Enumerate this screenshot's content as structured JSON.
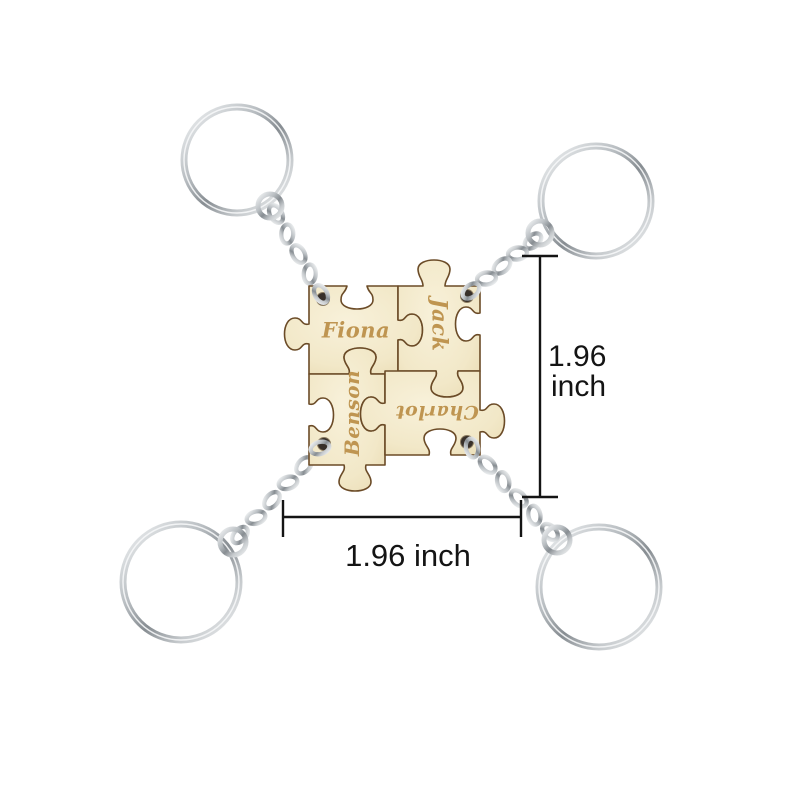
{
  "scene": {
    "description": "Personalized wooden jigsaw puzzle keychain set: four engraved name pieces joined in a square, each corner piece attached by a silver chain to a split-ring keyring",
    "background": "#ffffff"
  },
  "pieces": [
    {
      "name": "Fiona",
      "position": "top-left",
      "text_rotation_deg": 0
    },
    {
      "name": "Jack",
      "position": "top-right",
      "text_rotation_deg": 90
    },
    {
      "name": "Benson",
      "position": "bottom-left",
      "text_rotation_deg": -90
    },
    {
      "name": "Charlot",
      "position": "bottom-right",
      "text_rotation_deg": 180
    }
  ],
  "annotations": {
    "vertical": {
      "value": "1.96",
      "unit": "inch"
    },
    "horizontal": {
      "label": "1.96 inch"
    }
  },
  "colors": {
    "wood": "#f2e8c8",
    "wood_highlight": "#f8f1da",
    "wood_shadow": "#e7d8ae",
    "wood_edge": "#6b4b27",
    "engraving": "#bf9551",
    "metal_light": "#f2f4f5",
    "metal_mid": "#878d92",
    "annotation": "#141414"
  }
}
